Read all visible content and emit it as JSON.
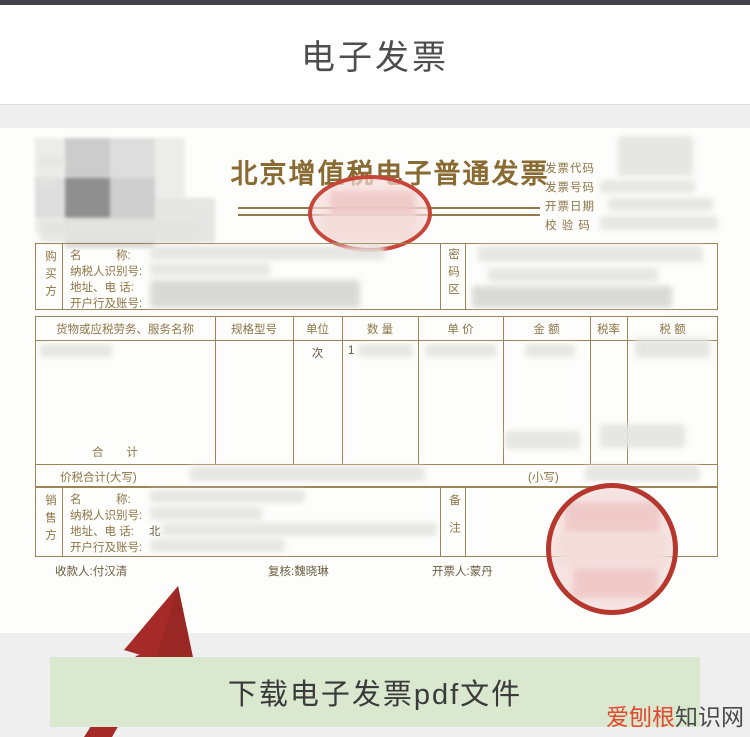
{
  "app": {
    "title": "电子发票"
  },
  "invoice": {
    "title": "北京增值税电子普通发票",
    "header_fields": [
      "发票代码",
      "发票号码",
      "开票日期",
      "校 验 码"
    ],
    "buyer": {
      "side_label": "购买方",
      "fields": [
        "名　　　称:",
        "纳税人识别号:",
        "地址、电 话:",
        "开户行及账号:"
      ],
      "password_label": "密码区"
    },
    "table": {
      "columns": [
        "货物或应税劳务、服务名称",
        "规格型号",
        "单位",
        "数 量",
        "单 价",
        "金 额",
        "税率",
        "税 额"
      ],
      "unit_value": "次",
      "qty_value": "1",
      "total_label": "合　　计",
      "tax_total_label": "价税合计(大写)",
      "small_label": "(小写)"
    },
    "seller": {
      "side_label": "销售方",
      "fields": [
        "名　　　称:",
        "纳税人识别号:",
        "地址、电 话:",
        "开户行及账号:"
      ],
      "remark_label": "备注",
      "address_prefix": "北"
    },
    "footer": {
      "payee_label": "收款人:",
      "payee": "付汉清",
      "reviewer_label": "复核:",
      "reviewer": "魏晓琳",
      "drawer_label": "开票人:",
      "drawer": "蒙丹"
    }
  },
  "download_button": {
    "label": "下载电子发票pdf文件"
  },
  "watermark": {
    "red": "爱刨根",
    "dark": "知识网"
  },
  "colors": {
    "gold_line": "#9b8455",
    "gold_text": "#8d7547",
    "stamp_red": "#bf3a2e",
    "arrow_red": "#a62b28",
    "button_green": "#d9e8cf",
    "watermark_red": "#e2492e"
  }
}
